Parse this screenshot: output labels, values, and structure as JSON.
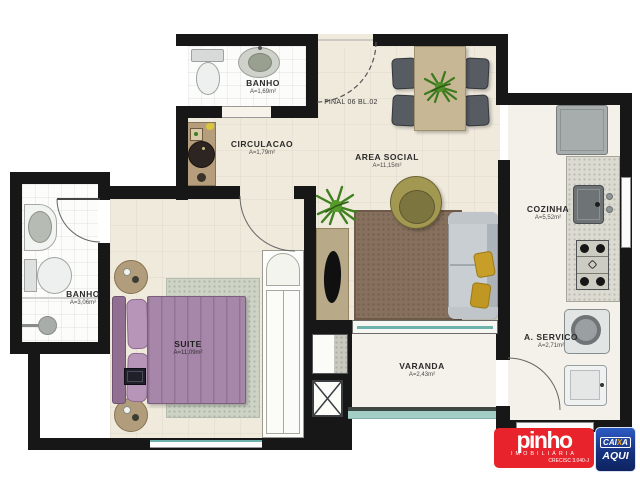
{
  "unit": {
    "label": "FINAL 06 BL.02"
  },
  "rooms": {
    "banho1": {
      "label": "BANHO",
      "area": "A=1,69m²"
    },
    "circulacao": {
      "label": "CIRCULACAO",
      "area": "A=1,79m²"
    },
    "area_social": {
      "label": "AREA SOCIAL",
      "area": "A=11,15m²"
    },
    "cozinha": {
      "label": "COZINHA",
      "area": "A=5,52m²"
    },
    "banho2": {
      "label": "BANHO",
      "area": "A=3,06m²"
    },
    "suite": {
      "label": "SUITE",
      "area": "A=11,09m²"
    },
    "varanda": {
      "label": "VARANDA",
      "area": "A=2,43m²"
    },
    "servico": {
      "label": "A. SERVICO",
      "area": "A=2,71m²"
    }
  },
  "logo": {
    "brand": "pinho",
    "subtitle": "IMOBILIÁRIA",
    "license": "CRECISC 3.040-J",
    "badge": {
      "line1_pre": "CAI",
      "line1_x": "X",
      "line1_post": "A",
      "line2": "AQUI"
    },
    "colors": {
      "red": "#e8232b",
      "blue": "#16337f",
      "orange": "#f6a000"
    }
  },
  "palette": {
    "wall": "#171717",
    "floor_cream": "#f0eadd",
    "bathroom_tile": "#fcfcfb",
    "bed_purple": "#a787a9",
    "sofa_gray": "#c9ced2",
    "rug_brown": "#87705d",
    "suite_rug_green": "#cdd4c6",
    "glass_teal": "#6db3ab",
    "wood_tan": "#c7b795"
  },
  "fixtures": [
    "toilet",
    "washbasin",
    "shower",
    "double-bed",
    "nightstand",
    "wardrobe",
    "sofa",
    "armchair",
    "tv-console",
    "dining-table",
    "dining-chair",
    "plant",
    "fridge",
    "kitchen-sink",
    "cooktop",
    "washing-machine",
    "laundry-tank",
    "service-shaft",
    "door-swing",
    "railing"
  ]
}
